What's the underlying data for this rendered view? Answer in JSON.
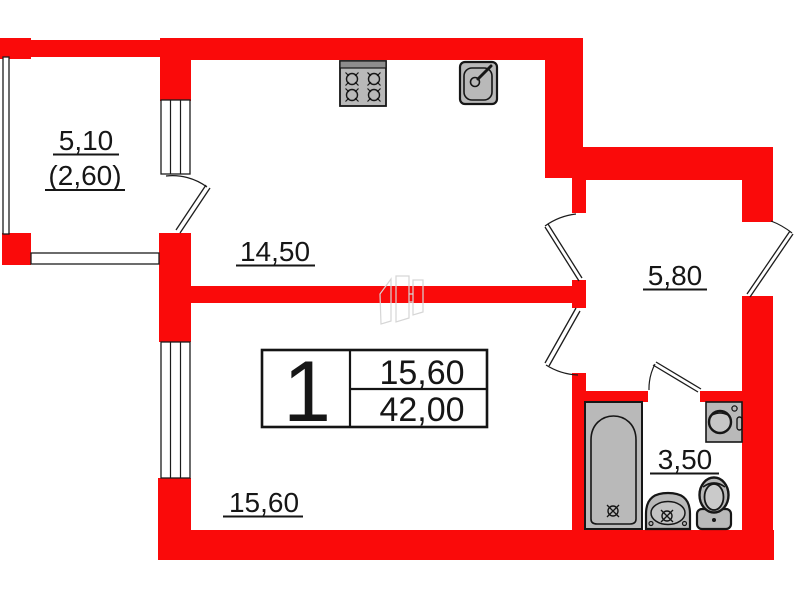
{
  "plan_type": "apartment-floor-plan",
  "colors": {
    "wall": "#fa0a0a",
    "fixture_fill": "#b9b9b9",
    "line": "#1c1c1c"
  },
  "rooms": {
    "balcony": {
      "area": "5,10",
      "area_with_coefficient": "(2,60)"
    },
    "kitchen": {
      "area": "14,50"
    },
    "hallway": {
      "area": "5,80"
    },
    "living_room": {
      "area": "15,60"
    },
    "bathroom": {
      "area": "3,50"
    }
  },
  "info_table": {
    "room_count": "1",
    "living_area": "15,60",
    "total_area": "42,00"
  },
  "fixtures": {
    "kitchen": [
      "stove",
      "sink"
    ],
    "bathroom": [
      "bathtub",
      "washing-machine",
      "wash-basin",
      "toilet"
    ]
  }
}
